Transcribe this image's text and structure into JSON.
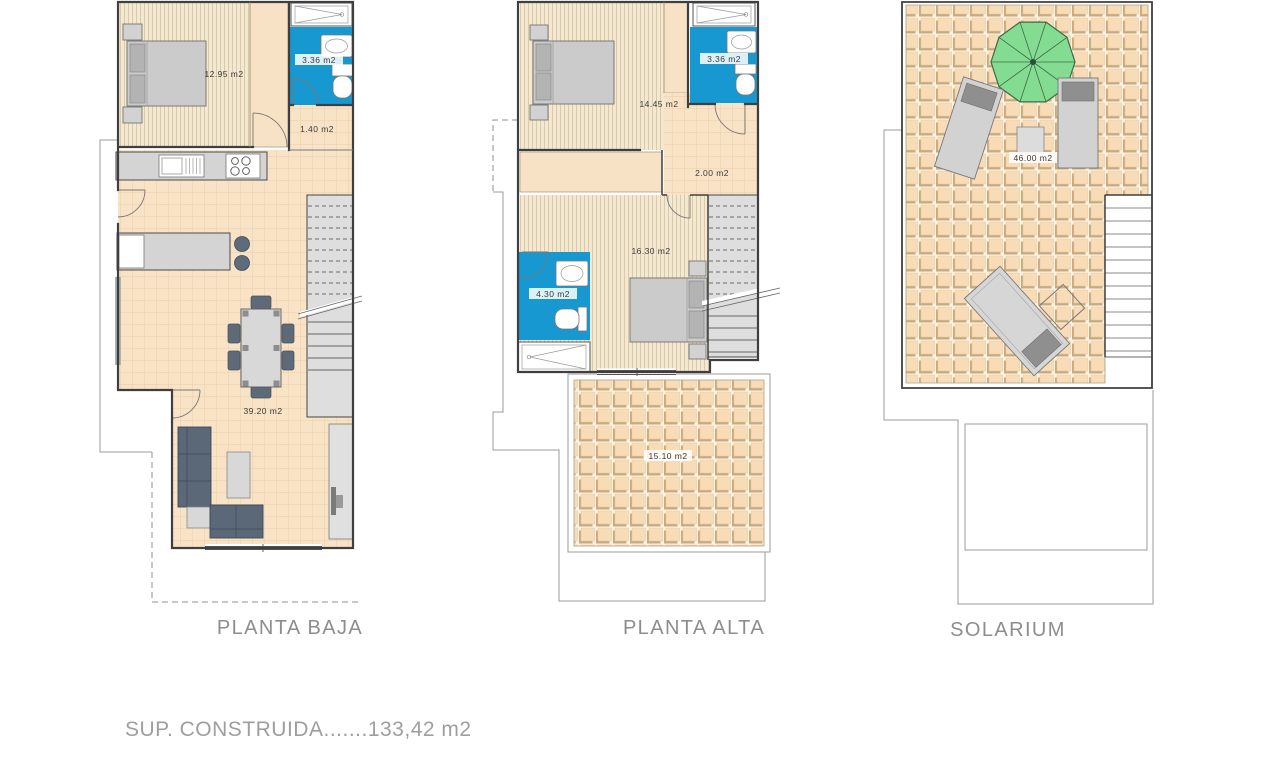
{
  "sheet": {
    "summary_text": "SUP. CONSTRUIDA.......133,42 m2"
  },
  "plans": {
    "planta_baja": {
      "title": "PLANTA BAJA",
      "labels": {
        "bedroom": "12.95 m2",
        "bathroom": "3.36 m2",
        "hall": "1.40 m2",
        "living_kitchen": "39.20 m2"
      }
    },
    "planta_alta": {
      "title": "PLANTA ALTA",
      "labels": {
        "bedroom_main": "14.45 m2",
        "bathroom_top": "3.36 m2",
        "landing": "2.00 m2",
        "bedroom_second": "16.30 m2",
        "bathroom_ensuite": "4.30 m2",
        "terrace": "15.10 m2"
      }
    },
    "solarium": {
      "title": "SOLARIUM",
      "labels": {
        "roof_terrace": "46.00 m2"
      }
    }
  },
  "colors": {
    "bathroom_blue": "#1798d0",
    "wood_floor": "#f3e9d3",
    "tile_floor": "#f9e3c6",
    "terrace_tile": "#f8dcb8",
    "umbrella_green": "#84dc92",
    "wall": "#3f3f3f",
    "furniture_gray": "#d2d2d2",
    "sofa_dark": "#5a6878",
    "title_text": "#8d8d8d",
    "label_text": "#3a3a3a"
  }
}
